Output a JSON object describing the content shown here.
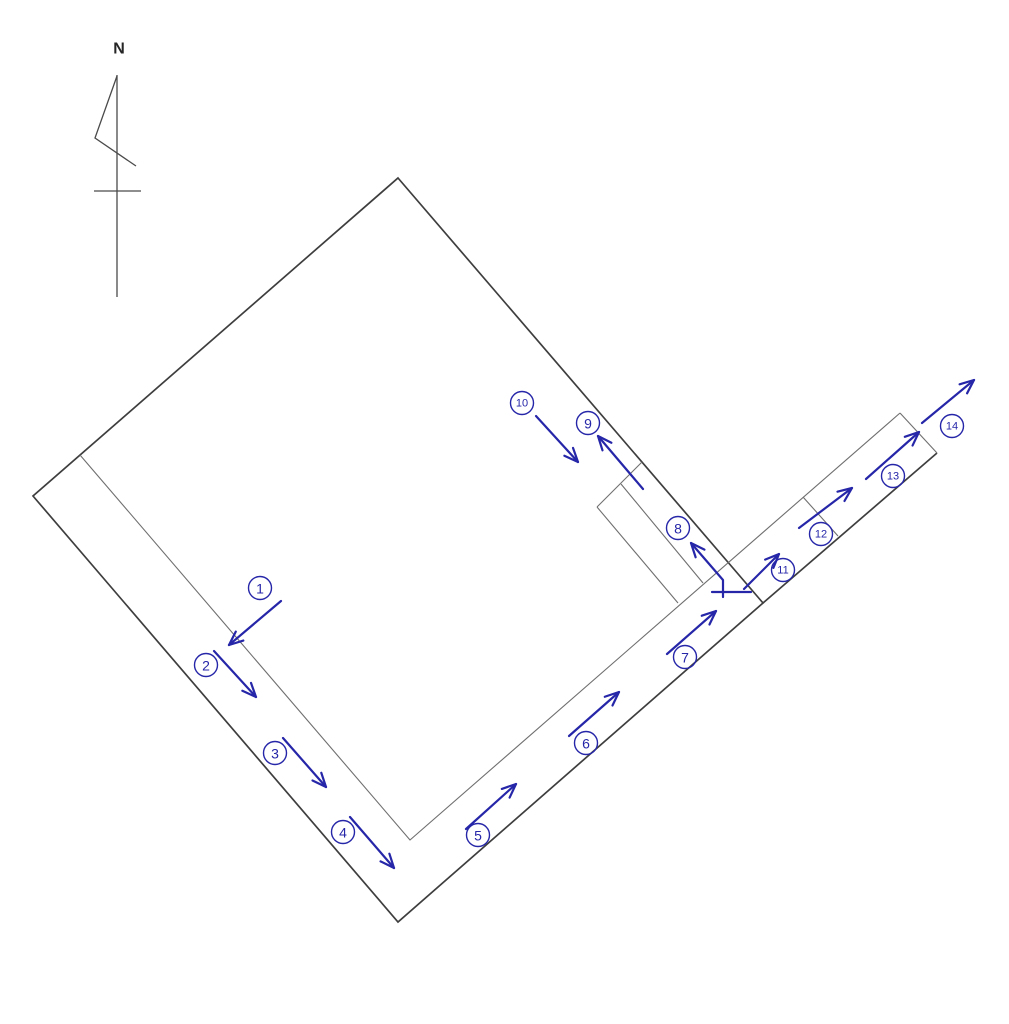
{
  "diagram": {
    "colors": {
      "boundary_dark": "#3e3e3e",
      "boundary_light": "#6f6f6f",
      "annotation_blue": "#2626a9",
      "background": "#ffffff"
    },
    "north_indicator": {
      "label": "N",
      "label_pos": [
        119,
        49
      ],
      "pole": [
        [
          117,
          75
        ],
        [
          117,
          297
        ]
      ],
      "flag": [
        [
          117,
          76
        ],
        [
          95,
          138
        ],
        [
          136,
          166
        ]
      ],
      "crossbar": [
        [
          94,
          191
        ],
        [
          141,
          191
        ]
      ]
    },
    "parcel": {
      "points": [
        [
          398,
          178
        ],
        [
          763,
          603
        ],
        [
          398,
          922
        ],
        [
          33,
          496
        ]
      ]
    },
    "lines": [
      {
        "name": "strip-lower-edge-extension",
        "style": "dark",
        "points": [
          [
            763,
            603
          ],
          [
            937,
            453
          ]
        ]
      },
      {
        "name": "inner-corridor-line",
        "style": "light",
        "points": [
          [
            80,
            455
          ],
          [
            410,
            840
          ],
          [
            900,
            413
          ]
        ]
      },
      {
        "name": "strip-end-cap",
        "style": "light",
        "points": [
          [
            900,
            413
          ],
          [
            937,
            453
          ]
        ]
      },
      {
        "name": "strip-division-line",
        "style": "light",
        "points": [
          [
            803,
            497
          ],
          [
            838,
            536
          ]
        ]
      },
      {
        "name": "notch-outer-side",
        "style": "light",
        "points": [
          [
            597,
            507
          ],
          [
            678,
            603
          ]
        ]
      },
      {
        "name": "notch-top-cap",
        "style": "light",
        "points": [
          [
            597,
            507
          ],
          [
            642,
            462
          ]
        ]
      },
      {
        "name": "notch-divider",
        "style": "light",
        "points": [
          [
            621,
            484
          ],
          [
            703,
            583
          ]
        ]
      },
      {
        "name": "arrow-8-base-crossbar",
        "style": "blue",
        "points": [
          [
            712,
            592
          ],
          [
            751,
            592
          ]
        ]
      }
    ],
    "label_style": {
      "radius": 11.5,
      "font_single": 14,
      "font_double": 11
    },
    "markers": [
      {
        "num": "1",
        "circle": [
          260,
          588
        ],
        "arrow": [
          [
            281,
            601
          ],
          [
            229,
            645
          ]
        ]
      },
      {
        "num": "2",
        "circle": [
          206,
          665
        ],
        "arrow": [
          [
            214,
            651
          ],
          [
            256,
            697
          ]
        ]
      },
      {
        "num": "3",
        "circle": [
          275,
          753
        ],
        "arrow": [
          [
            283,
            738
          ],
          [
            326,
            787
          ]
        ]
      },
      {
        "num": "4",
        "circle": [
          343,
          832
        ],
        "arrow": [
          [
            350,
            817
          ],
          [
            394,
            868
          ]
        ]
      },
      {
        "num": "5",
        "circle": [
          478,
          835
        ],
        "arrow": [
          [
            466,
            829
          ],
          [
            516,
            784
          ]
        ]
      },
      {
        "num": "6",
        "circle": [
          586,
          743
        ],
        "arrow": [
          [
            569,
            736
          ],
          [
            619,
            692
          ]
        ]
      },
      {
        "num": "7",
        "circle": [
          685,
          657
        ],
        "arrow": [
          [
            667,
            654
          ],
          [
            716,
            611
          ]
        ]
      },
      {
        "num": "8",
        "circle": [
          678,
          528
        ],
        "arrow": [
          [
            723,
            597
          ],
          [
            723,
            580
          ],
          [
            691,
            543
          ]
        ]
      },
      {
        "num": "9",
        "circle": [
          588,
          423
        ],
        "arrow": [
          [
            643,
            489
          ],
          [
            598,
            436
          ]
        ]
      },
      {
        "num": "10",
        "circle": [
          522,
          403
        ],
        "arrow": [
          [
            536,
            416
          ],
          [
            578,
            462
          ]
        ]
      },
      {
        "num": "11",
        "circle": [
          783,
          570
        ],
        "arrow": [
          [
            744,
            589
          ],
          [
            779,
            554
          ]
        ]
      },
      {
        "num": "12",
        "circle": [
          821,
          534
        ],
        "arrow": [
          [
            799,
            528
          ],
          [
            852,
            488
          ]
        ]
      },
      {
        "num": "13",
        "circle": [
          893,
          476
        ],
        "arrow": [
          [
            866,
            479
          ],
          [
            919,
            432
          ]
        ]
      },
      {
        "num": "14",
        "circle": [
          952,
          426
        ],
        "arrow": [
          [
            922,
            423
          ],
          [
            974,
            380
          ]
        ]
      }
    ]
  }
}
